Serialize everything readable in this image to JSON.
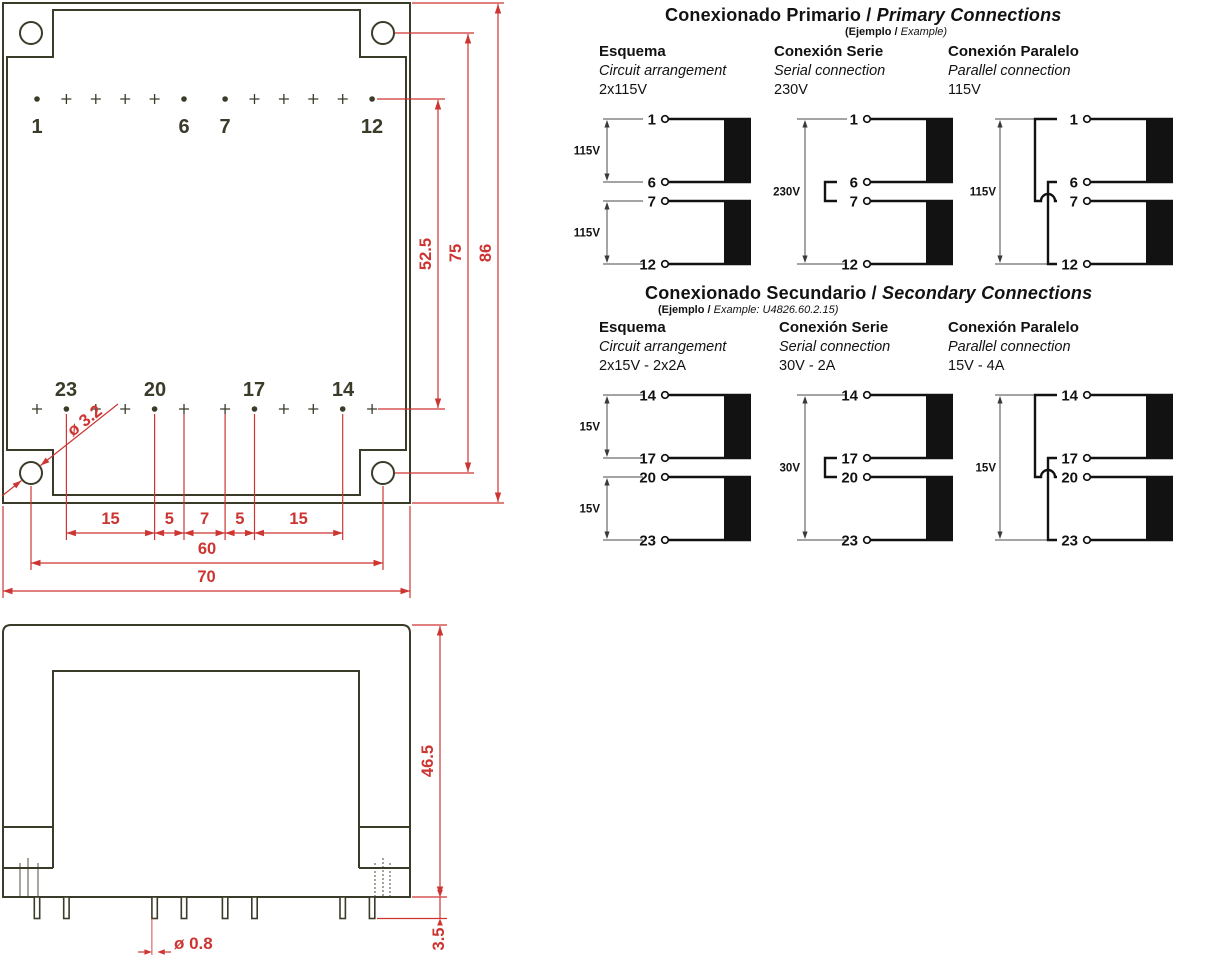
{
  "colors": {
    "drawing_line": "#3b3b29",
    "dimension_red": "#cc3532",
    "diagram_ink": "#121212",
    "diagram_dim": "#4a4a4a"
  },
  "mechanical": {
    "top_view": {
      "top_pin_labels": [
        "1",
        "6",
        "7",
        "12"
      ],
      "bottom_pin_labels": [
        "23",
        "20",
        "17",
        "14"
      ],
      "dim_pin_rows": "52.5",
      "dim_holes_vertical": "75",
      "dim_height": "86",
      "dim_pitch": [
        "15",
        "5",
        "7",
        "5",
        "15"
      ],
      "dim_holes_horizontal": "60",
      "dim_width": "70",
      "hole_diameter": "ø 3.2"
    },
    "side_view": {
      "dim_body_height": "46.5",
      "dim_pin_length": "3.5",
      "pin_diameter": "ø 0.8"
    }
  },
  "primary": {
    "title_es": "Conexionado Primario",
    "title_sep": " / ",
    "title_en": "Primary Connections",
    "subtitle_es": "(Ejemplo / ",
    "subtitle_en": "Example)",
    "columns": [
      {
        "name_es": "Esquema",
        "name_en": "Circuit arrangement",
        "value": "2x115V"
      },
      {
        "name_es": "Conexión Serie",
        "name_en": "Serial connection",
        "value": "230V"
      },
      {
        "name_es": "Conexión Paralelo",
        "name_en": "Parallel connection",
        "value": "115V"
      }
    ],
    "diagrams": [
      {
        "type": "esquema",
        "pins": [
          "1",
          "6",
          "7",
          "12"
        ],
        "winding_labels": [
          "115V",
          "115V"
        ]
      },
      {
        "type": "serie",
        "pins": [
          "1",
          "6",
          "7",
          "12"
        ],
        "span_label": "230V"
      },
      {
        "type": "paralelo",
        "pins": [
          "1",
          "6",
          "7",
          "12"
        ],
        "span_label": "115V"
      }
    ]
  },
  "secondary": {
    "title_es": "Conexionado Secundario",
    "title_sep": " / ",
    "title_en": "Secondary Connections",
    "subtitle_es": "(Ejemplo / ",
    "subtitle_en": "Example: U4826.60.2.15)",
    "columns": [
      {
        "name_es": "Esquema",
        "name_en": "Circuit arrangement",
        "value": "2x15V - 2x2A"
      },
      {
        "name_es": "Conexión Serie",
        "name_en": "Serial connection",
        "value": "30V - 2A"
      },
      {
        "name_es": "Conexión Paralelo",
        "name_en": "Parallel connection",
        "value": "15V - 4A"
      }
    ],
    "diagrams": [
      {
        "type": "esquema",
        "pins": [
          "14",
          "17",
          "20",
          "23"
        ],
        "winding_labels": [
          "15V",
          "15V"
        ]
      },
      {
        "type": "serie",
        "pins": [
          "14",
          "17",
          "20",
          "23"
        ],
        "span_label": "30V"
      },
      {
        "type": "paralelo",
        "pins": [
          "14",
          "17",
          "20",
          "23"
        ],
        "span_label": "15V"
      }
    ]
  }
}
